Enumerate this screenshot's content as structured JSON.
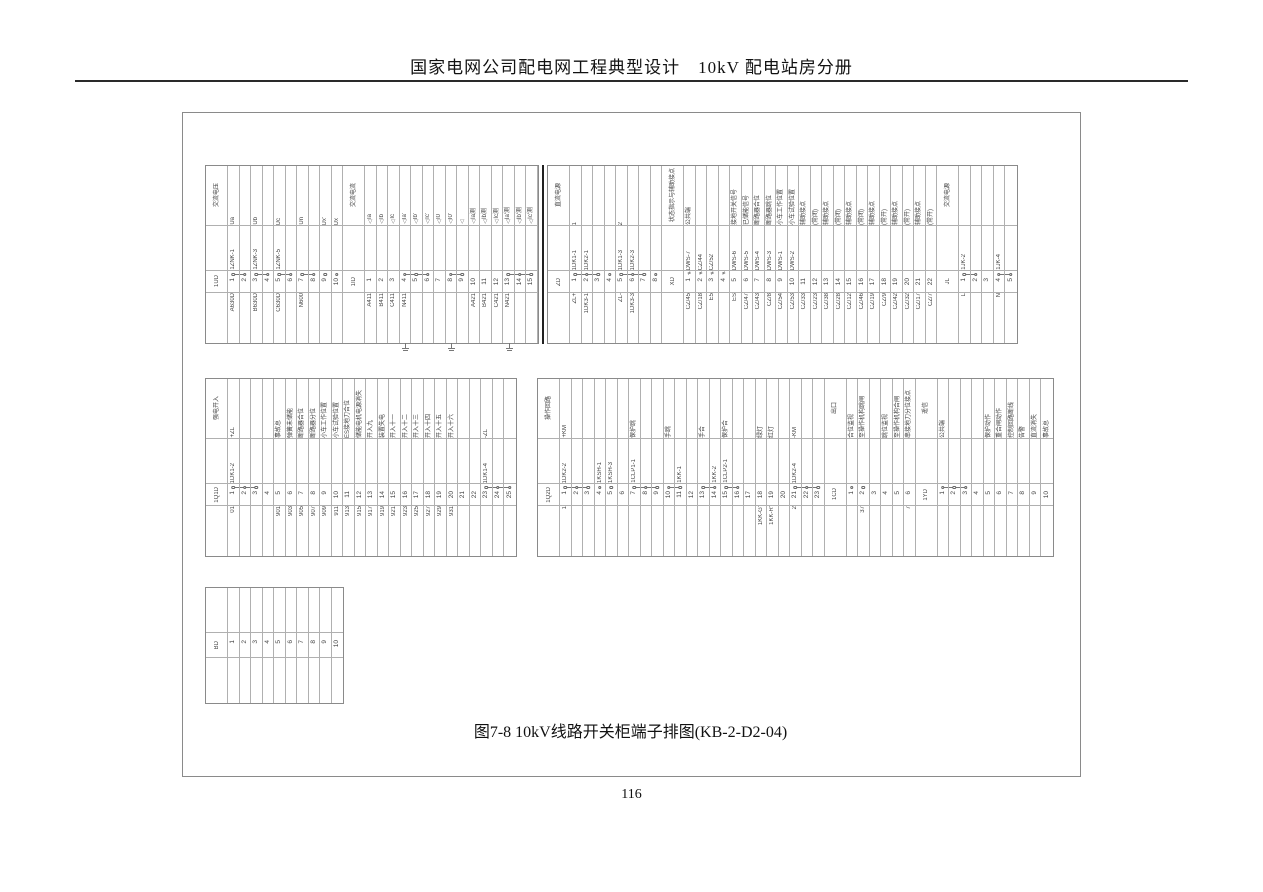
{
  "page": {
    "header": "国家电网公司配电网工程典型设计　10kV 配电站房分册",
    "caption": "图7-8 10kV线路开关柜端子排图(KB-2-D2-04)",
    "page_number": "116"
  },
  "strips": [
    [
      {
        "name": "1UD",
        "header": "交流电压",
        "terminals": [
          {
            "n": "1",
            "outer": "A630D",
            "inner": "1ZNK-1",
            "label": "Ua",
            "s": "j1"
          },
          {
            "n": "2",
            "s": "j2"
          },
          {
            "n": "3",
            "outer": "B630D",
            "inner": "1ZNK-3",
            "label": "Ub",
            "s": "j1"
          },
          {
            "n": "4",
            "s": "j2"
          },
          {
            "n": "5",
            "outer": "C630D",
            "inner": "1ZNK-5",
            "label": "Uc",
            "s": "j1"
          },
          {
            "n": "6",
            "s": "j2"
          },
          {
            "n": "7",
            "outer": "N600",
            "label": "Un",
            "s": "j1"
          },
          {
            "n": "8",
            "s": "j2"
          },
          {
            "n": "9",
            "label": "Ux'",
            "s": "o"
          },
          {
            "n": "10",
            "label": "Ux",
            "s": "o"
          }
        ]
      },
      {
        "name": "1ID",
        "header": "交流电流",
        "grounds": [
          4,
          8,
          13
        ],
        "terminals": [
          {
            "n": "1",
            "outer": "A411",
            "label": "Ia",
            "tri": true
          },
          {
            "n": "2",
            "outer": "B411",
            "label": "Ib",
            "tri": true
          },
          {
            "n": "3",
            "outer": "C411",
            "label": "Ic",
            "tri": true
          },
          {
            "n": "4",
            "outer": "N411",
            "label": "Ia'",
            "tri": true,
            "s": "j1"
          },
          {
            "n": "5",
            "label": "Ib'",
            "tri": true,
            "s": "jm"
          },
          {
            "n": "6",
            "label": "Ic'",
            "tri": true,
            "s": "j2"
          },
          {
            "n": "7",
            "label": "I0",
            "tri": true
          },
          {
            "n": "8",
            "label": "I0'",
            "tri": true,
            "s": "j1"
          },
          {
            "n": "9",
            "tri": true,
            "s": "j2"
          },
          {
            "n": "10",
            "outer": "A421",
            "label": "Ia测",
            "tri": true
          },
          {
            "n": "11",
            "outer": "B421",
            "label": "Ib测",
            "tri": true
          },
          {
            "n": "12",
            "outer": "C421",
            "label": "Ic测",
            "tri": true
          },
          {
            "n": "13",
            "outer": "N421",
            "label": "Ia'测",
            "tri": true,
            "s": "j1"
          },
          {
            "n": "14",
            "label": "Ib'测",
            "tri": true,
            "s": "jm"
          },
          {
            "n": "15",
            "label": "Ic'测",
            "tri": true,
            "s": "j2"
          }
        ]
      }
    ],
    [
      {
        "name": "ZD",
        "header": "直流电源",
        "terminals": [
          {
            "n": "1",
            "outer": "ZL+",
            "inner": "1DK1-1",
            "label": "1",
            "s": "j1"
          },
          {
            "n": "2",
            "outer": "1DK3-1",
            "inner": "1DK2-1",
            "s": "jm"
          },
          {
            "n": "3",
            "s": "j2"
          },
          {
            "n": "4",
            "s": "o"
          },
          {
            "n": "5",
            "outer": "ZL-",
            "inner": "1DK1-3",
            "label": "2",
            "s": "j1"
          },
          {
            "n": "6",
            "outer": "1DK3-3",
            "inner": "1DK2-3",
            "s": "jm"
          },
          {
            "n": "7",
            "s": "j2"
          },
          {
            "n": "8",
            "s": "o"
          }
        ]
      },
      {
        "name": "XD",
        "header": "状态指示与辅助接点",
        "terminals": [
          {
            "n": "1",
            "outer": "CZ/45",
            "inner": "DWS-7",
            "label": "公共端",
            "s": "x"
          },
          {
            "n": "2",
            "outer": "CZ/18",
            "inner": "CZ/44",
            "s": "x"
          },
          {
            "n": "3",
            "outer": "E5",
            "inner": "CZ/52",
            "s": "x"
          },
          {
            "n": "4",
            "s": "x"
          },
          {
            "n": "5",
            "outer": "ES",
            "inner": "DWS-6",
            "label": "接地开关信号"
          },
          {
            "n": "6",
            "outer": "CZ/47",
            "inner": "DWS-5",
            "label": "已储能信号"
          },
          {
            "n": "7",
            "outer": "CZ/43",
            "inner": "DWS-4",
            "label": "断路器合位"
          },
          {
            "n": "8",
            "outer": "CZ/8",
            "inner": "DWS-3",
            "label": "断路器跳位"
          },
          {
            "n": "9",
            "outer": "CZ/54",
            "inner": "DWS-1",
            "label": "小车工作位置"
          },
          {
            "n": "10",
            "outer": "CZ/53",
            "inner": "DWS-2",
            "label": "小车试验位置"
          },
          {
            "n": "11",
            "outer": "CZ/33",
            "label": "辅助接点"
          },
          {
            "n": "12",
            "outer": "CZ/23",
            "label": "(常闭)"
          },
          {
            "n": "13",
            "outer": "CZ/38",
            "label": "辅助接点"
          },
          {
            "n": "14",
            "outer": "CZ/28",
            "label": "(常闭)"
          },
          {
            "n": "15",
            "outer": "CZ/12",
            "label": "辅助接点"
          },
          {
            "n": "16",
            "outer": "CZ/46",
            "label": "(常闭)"
          },
          {
            "n": "17",
            "outer": "CZ/19",
            "label": "辅助接点"
          },
          {
            "n": "18",
            "outer": "CZ/9",
            "label": "(常开)"
          },
          {
            "n": "19",
            "outer": "CZ/42",
            "label": "辅助接点"
          },
          {
            "n": "20",
            "outer": "CZ/32",
            "label": "(常开)"
          },
          {
            "n": "21",
            "outer": "CZ/17",
            "label": "辅助接点"
          },
          {
            "n": "22",
            "outer": "CZ/7",
            "label": "(常开)"
          }
        ]
      },
      {
        "name": "JL",
        "header": "交流电源",
        "terminals": [
          {
            "n": "1",
            "outer": "L",
            "inner": "1JK-2",
            "s": "j1"
          },
          {
            "n": "2",
            "s": "j2"
          },
          {
            "n": "3"
          },
          {
            "n": "4",
            "outer": "N",
            "inner": "1JK-4",
            "s": "j1"
          },
          {
            "n": "5",
            "s": "j2"
          }
        ]
      }
    ],
    [
      {
        "name": "1Q1D",
        "header": "强电开入",
        "terminals": [
          {
            "n": "1",
            "outer": "01",
            "inner": "1DK1-2",
            "label": "+ZL",
            "s": "j1"
          },
          {
            "n": "2",
            "s": "jm"
          },
          {
            "n": "3",
            "s": "j2"
          },
          {
            "n": "4"
          },
          {
            "n": "5",
            "outer": "901",
            "label": "事故总"
          },
          {
            "n": "6",
            "outer": "903",
            "label": "弹簧未储能"
          },
          {
            "n": "7",
            "outer": "905",
            "label": "断路器合位"
          },
          {
            "n": "8",
            "outer": "907",
            "label": "断路器分位"
          },
          {
            "n": "9",
            "outer": "909",
            "label": "小车工作位置"
          },
          {
            "n": "10",
            "outer": "911",
            "label": "小车试验位置"
          },
          {
            "n": "11",
            "outer": "913",
            "label": "ES接地刀合位"
          },
          {
            "n": "12",
            "outer": "915",
            "label": "储能电机电源消失"
          },
          {
            "n": "13",
            "outer": "917",
            "label": "开入九"
          },
          {
            "n": "14",
            "outer": "919",
            "label": "装置失电"
          },
          {
            "n": "15",
            "outer": "921",
            "label": "开入十一"
          },
          {
            "n": "16",
            "outer": "923",
            "label": "开入十二"
          },
          {
            "n": "17",
            "outer": "925",
            "label": "开入十三"
          },
          {
            "n": "18",
            "outer": "927",
            "label": "开入十四"
          },
          {
            "n": "19",
            "outer": "929",
            "label": "开入十五"
          },
          {
            "n": "20",
            "outer": "931",
            "label": "开入十六"
          },
          {
            "n": "21"
          },
          {
            "n": "22"
          },
          {
            "n": "23",
            "inner": "1DK1-4",
            "label": "-ZL",
            "s": "j1"
          },
          {
            "n": "24",
            "s": "jm"
          },
          {
            "n": "25",
            "s": "j2"
          }
        ]
      }
    ],
    [
      {
        "name": "1Q2D",
        "header": "操作回路",
        "terminals": [
          {
            "n": "1",
            "outer": "1",
            "inner": "1DK2-2",
            "label": "+KM",
            "s": "j1"
          },
          {
            "n": "2",
            "s": "jm"
          },
          {
            "n": "3",
            "s": "j2"
          },
          {
            "n": "4",
            "inner": "1KSH-1",
            "s": "o"
          },
          {
            "n": "5",
            "inner": "1KSH-3",
            "s": "o"
          },
          {
            "n": "6"
          },
          {
            "n": "7",
            "inner": "1CLP1-1",
            "label": "保护跳",
            "s": "j1"
          },
          {
            "n": "8",
            "s": "jm"
          },
          {
            "n": "9",
            "s": "j2"
          },
          {
            "n": "10",
            "label": "手跳",
            "s": "j1"
          },
          {
            "n": "11",
            "inner": "1KK-1",
            "s": "j2"
          },
          {
            "n": "12"
          },
          {
            "n": "13",
            "label": "手合",
            "s": "j1"
          },
          {
            "n": "14",
            "inner": "1KK-2",
            "s": "j2"
          },
          {
            "n": "15",
            "inner": "1CLP2-1",
            "label": "保护合",
            "s": "j1"
          },
          {
            "n": "16",
            "s": "j2"
          },
          {
            "n": "17"
          },
          {
            "n": "18",
            "outer": "1KK-G'",
            "label": "绿灯"
          },
          {
            "n": "19",
            "outer": "1KK-R'",
            "label": "红灯"
          },
          {
            "n": "20"
          },
          {
            "n": "21",
            "outer": "2",
            "inner": "1DK2-4",
            "label": "-KM",
            "s": "j1"
          },
          {
            "n": "22",
            "s": "jm"
          },
          {
            "n": "23",
            "s": "j2"
          }
        ]
      },
      {
        "name": "1CD",
        "header": "出口",
        "terminals": [
          {
            "n": "1",
            "label": "合位监视",
            "s": "o"
          },
          {
            "n": "2",
            "outer": "37",
            "label": "至操作机构跳闸",
            "s": "o"
          },
          {
            "n": "3"
          },
          {
            "n": "4",
            "label": "跳位监视"
          },
          {
            "n": "5",
            "label": "至操作机构合闸"
          },
          {
            "n": "6",
            "outer": "7",
            "label": "串接地刀分位接点"
          }
        ]
      },
      {
        "name": "1YD",
        "header": "遥信",
        "terminals": [
          {
            "n": "1",
            "label": "公共端",
            "s": "j1"
          },
          {
            "n": "2",
            "s": "jm"
          },
          {
            "n": "3",
            "s": "j2"
          },
          {
            "n": "4"
          },
          {
            "n": "5",
            "label": "保护动作"
          },
          {
            "n": "6",
            "label": "重合闸动作"
          },
          {
            "n": "7",
            "label": "控制回路断线"
          },
          {
            "n": "8",
            "label": "告警"
          },
          {
            "n": "9",
            "label": "直流消失"
          },
          {
            "n": "10",
            "label": "事故总"
          }
        ]
      }
    ],
    [
      {
        "name": "BD",
        "header": "",
        "terminals": [
          {
            "n": "1"
          },
          {
            "n": "2"
          },
          {
            "n": "3"
          },
          {
            "n": "4"
          },
          {
            "n": "5"
          },
          {
            "n": "6"
          },
          {
            "n": "7"
          },
          {
            "n": "8"
          },
          {
            "n": "9"
          },
          {
            "n": "10"
          }
        ]
      }
    ]
  ]
}
